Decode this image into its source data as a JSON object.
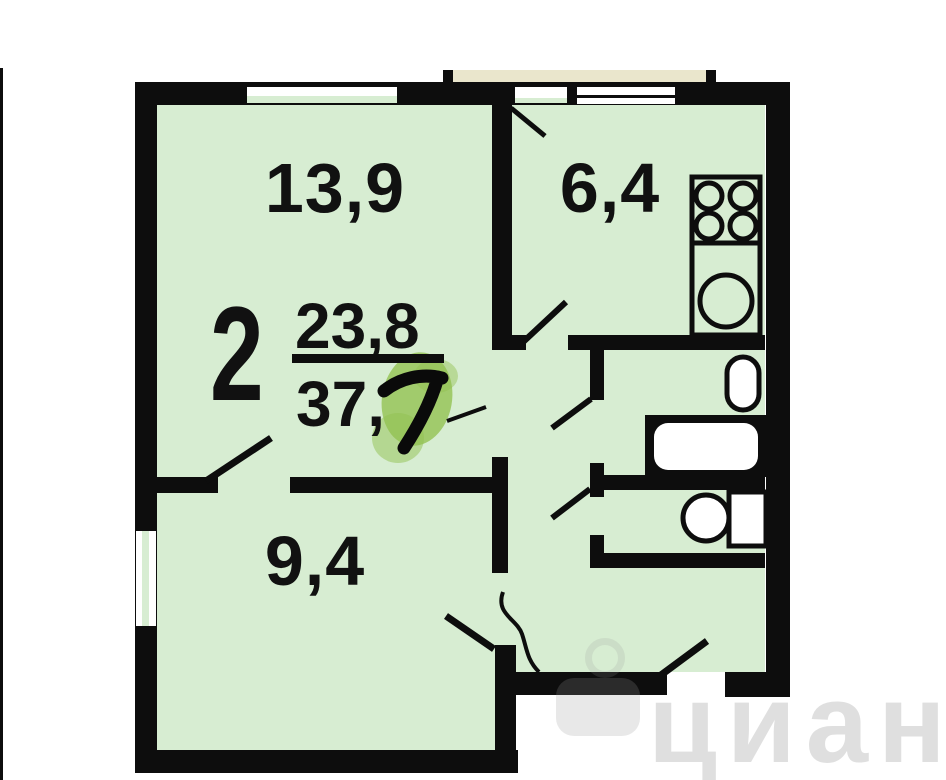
{
  "plan": {
    "summary": {
      "rooms_count": "2",
      "living_area": "23,8",
      "total_area_printed": "37,",
      "total_area_handwritten_digit": "7"
    },
    "rooms": [
      {
        "name": "room-large",
        "area": "13,9"
      },
      {
        "name": "kitchen",
        "area": "6,4"
      },
      {
        "name": "room-small",
        "area": "9,4"
      }
    ],
    "fixtures": [
      "stove",
      "kitchen-sink",
      "washbasin",
      "bathtub",
      "toilet"
    ],
    "colors": {
      "floor": "#d7edd2",
      "wall": "#0d0d0d",
      "balcony_slab": "#eae6cc",
      "highlight": "#92c24f",
      "window": "#ffffff"
    }
  },
  "watermark": {
    "text": "циан"
  }
}
